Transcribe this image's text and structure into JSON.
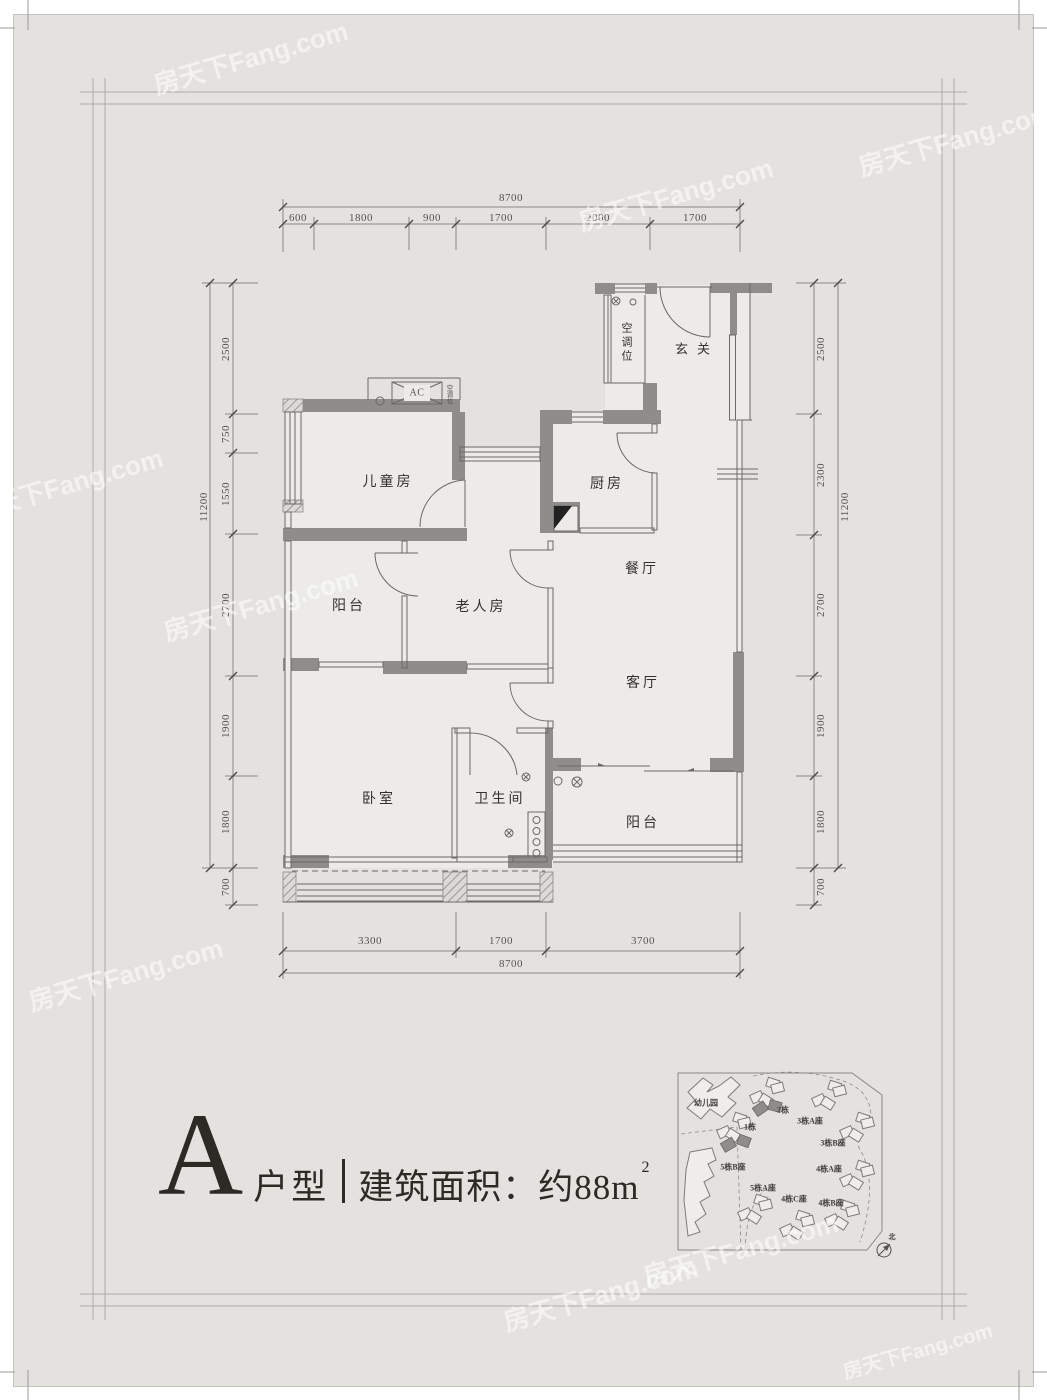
{
  "watermark": "房天下Fang.com",
  "title": {
    "letter": "A",
    "type": "户型",
    "area": "建筑面积：约88m",
    "area_sup": "2"
  },
  "floor_plan": {
    "rooms": {
      "entry": "玄关",
      "ac_shaft": "空调位",
      "ac_unit": "AC",
      "ac_small": "空调位",
      "children": "儿童房",
      "kitchen": "厨房",
      "dining": "餐厅",
      "balcony_upper": "阳台",
      "elder": "老人房",
      "living": "客厅",
      "bedroom": "卧室",
      "bathroom": "卫生间",
      "balcony_lower": "阳台"
    },
    "dims": {
      "top": {
        "overall": "8700",
        "segments": [
          "600",
          "1800",
          "900",
          "1700",
          "2000",
          "1700"
        ]
      },
      "bottom": {
        "overall": "8700",
        "segments": [
          "3300",
          "1700",
          "3700"
        ]
      },
      "left": {
        "overall": "11200",
        "segments": [
          "2500",
          "750",
          "1550",
          "2700",
          "1900",
          "1800",
          "700"
        ]
      },
      "right": {
        "overall": "11200",
        "segments": [
          "2500",
          "2300",
          "2700",
          "1900",
          "1800",
          "700"
        ]
      }
    }
  },
  "site_plan": {
    "buildings": [
      "幼儿园",
      "2栋",
      "1栋",
      "3栋A座",
      "3栋B座",
      "5栋B座",
      "4栋A座",
      "5栋A座",
      "4栋C座",
      "4栋B座"
    ],
    "north": "北"
  }
}
